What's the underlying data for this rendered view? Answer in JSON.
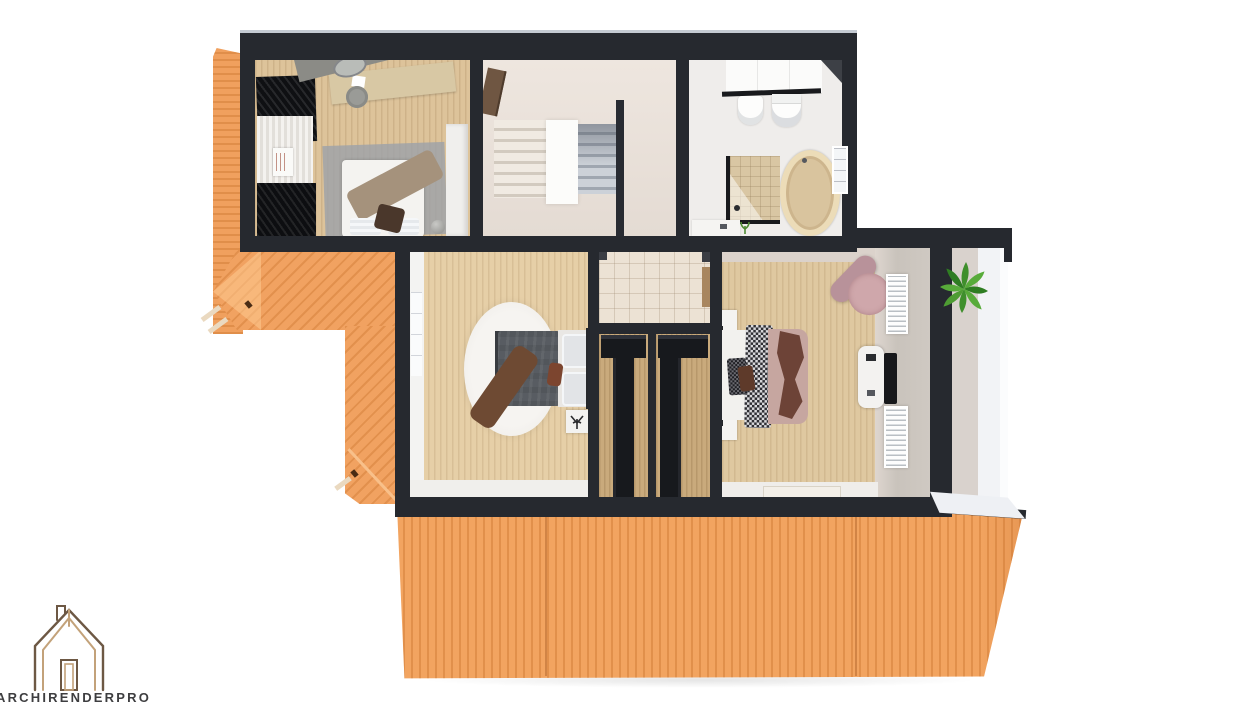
{
  "branding": {
    "logo_text": "ARCHIRENDERPRO",
    "logo_icon": "house-outline-icon",
    "logo_line_color_outer": "#6d5844",
    "logo_line_color_inner": "#c3a27a",
    "logo_text_color": "#3e3e40"
  },
  "palette": {
    "background": "#ffffff",
    "roof_orange": "#f2a460",
    "roof_stripe": "#c67028",
    "roof_ridge_highlight": "#f8c08a",
    "wall_dark": "#26292f",
    "floor_wood_bedroom1": "#ddc39a",
    "floor_wood_bedroom2": "#e6cfa7",
    "floor_wood_bedroom3": "#dfc8a0",
    "floor_closet": "#c9aa7c",
    "floor_stair_hall": "#e8dfd7",
    "floor_bathroom": "#efedeb",
    "floor_tile_hall": "#ece2d4",
    "floor_balcony": "#f2f3f6",
    "plant_green": "#4e9c33",
    "bed2_duvet_gray": "#585c62",
    "bed3_blanket_pink": "#c6a6a0",
    "bed3_blanket_brown": "#6d4337",
    "armchair_pink": "#c9a2a6"
  },
  "scene": {
    "type": "3d-floor-plan-render",
    "view": "top-down",
    "floors": [
      {
        "name": "upper-strip",
        "rooms": [
          {
            "name": "bedroom-1",
            "furniture": [
              "wardrobe-black",
              "curtain-panel",
              "dresser-white",
              "desk",
              "mirror-oval",
              "stool-round",
              "rug-gray",
              "double-bed-white",
              "blanket-brown",
              "cushion-dark",
              "cabinet-tall-white",
              "vase-sphere"
            ]
          },
          {
            "name": "stair-hall",
            "furniture": [
              "door-wood",
              "staircase-flight-left",
              "stair-landing",
              "staircase-flight-right",
              "wall-stub"
            ]
          },
          {
            "name": "bathroom",
            "furniture": [
              "vanity-panel",
              "towel-rail",
              "bidet",
              "toilet",
              "bathtub-oval",
              "shower-glass",
              "window",
              "vanity-low",
              "plant-sprig"
            ]
          }
        ]
      },
      {
        "name": "lower-strip",
        "rooms": [
          {
            "name": "bedroom-2",
            "furniture": [
              "rug-round-white",
              "double-bed-gray",
              "throw-brown",
              "pillow-accent",
              "nightstand",
              "plant-sprig"
            ]
          },
          {
            "name": "hall-tiled",
            "furniture": [
              "door-wood"
            ]
          },
          {
            "name": "walk-in-closet-left",
            "furniture": [
              "wardrobe-black-t"
            ]
          },
          {
            "name": "walk-in-closet-right",
            "furniture": [
              "wardrobe-black-t"
            ]
          },
          {
            "name": "bedroom-3",
            "furniture": [
              "double-bed-pink",
              "throw-houndstooth",
              "nightstand-top",
              "nightstand-bottom",
              "armchair-pink",
              "tv-console",
              "tv",
              "radiator-panel-top",
              "radiator-panel-bottom",
              "door-mat"
            ]
          },
          {
            "name": "balcony",
            "furniture": [
              "plant-green"
            ]
          }
        ]
      }
    ],
    "roof_sections": [
      "left-strip",
      "left-gable",
      "connector-strip",
      "main-lower-roof"
    ]
  }
}
